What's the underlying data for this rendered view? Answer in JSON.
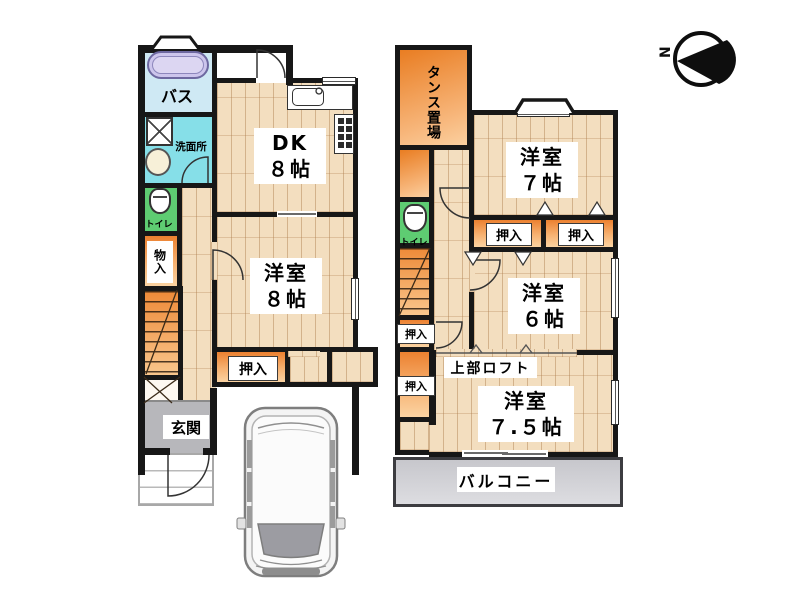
{
  "compass": {
    "north_label": "N"
  },
  "floor1": {
    "bath_label": "バス",
    "washroom_label": "洗面所",
    "toilet_label": "トイレ",
    "storage_label": "物入",
    "dk_label": [
      "DK",
      "８帖"
    ],
    "western_room8_label": [
      "洋室",
      "８帖"
    ],
    "closet_label": "押入",
    "entrance_label": "玄関"
  },
  "floor2": {
    "tansu_label": "タンス置場",
    "toilet_label": "トイレ",
    "western_room7_label": [
      "洋室",
      "７帖"
    ],
    "closet_top_left_label": "押入",
    "closet_top_right_label": "押入",
    "western_room6_label": [
      "洋室",
      "６帖"
    ],
    "closet_side_upper_label": "押入",
    "closet_side_lower_label": "押入",
    "loft_label": "上部ロフト",
    "western_room75_label": [
      "洋室",
      "７.５帖"
    ],
    "balcony_label": "バルコニー"
  },
  "palette": {
    "wall": "#171717",
    "wood_floor": "#f3debf",
    "closet_orange": "#ec8130",
    "bath_blue": "#cfe9f4",
    "washroom_cyan": "#86dfe8",
    "toilet_green": "#5ecc72",
    "entrance_gray": "#b7b7bb",
    "balcony_gray": "#cccccc"
  }
}
